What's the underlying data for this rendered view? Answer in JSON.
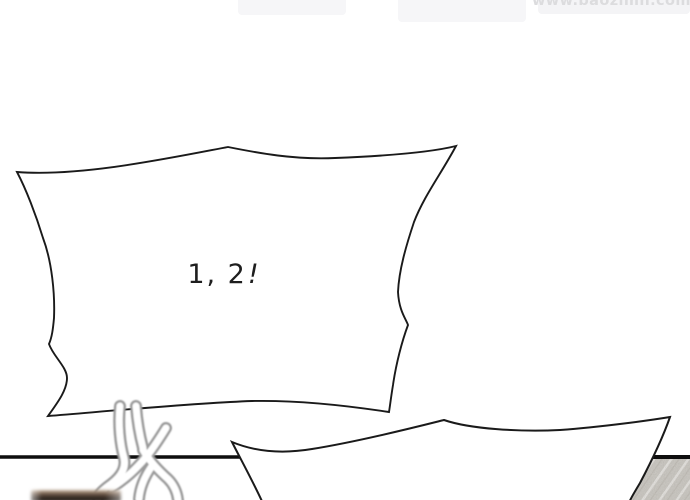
{
  "watermark": {
    "text": "www.baozimh.com",
    "color": "#dcdcde"
  },
  "colors": {
    "background": "#ffffff",
    "ink": "#1a1a1a",
    "divider": "#0e0e0e",
    "bubble_fill": "#ffffff",
    "sketch_gray": "#9a9a9a",
    "sketch_fill": "#ffffff",
    "floor_base": "#d6d3cd",
    "floor_streak": "#efede9",
    "floor_shade": "#c3bfb7"
  },
  "panel": {
    "speech_bubble_large": {
      "text": "1, 2!",
      "text_digits": "1, 2",
      "text_bang": "!"
    },
    "speech_bubble_small": {
      "note": "empty bubble, content cut off below panel edge"
    }
  }
}
